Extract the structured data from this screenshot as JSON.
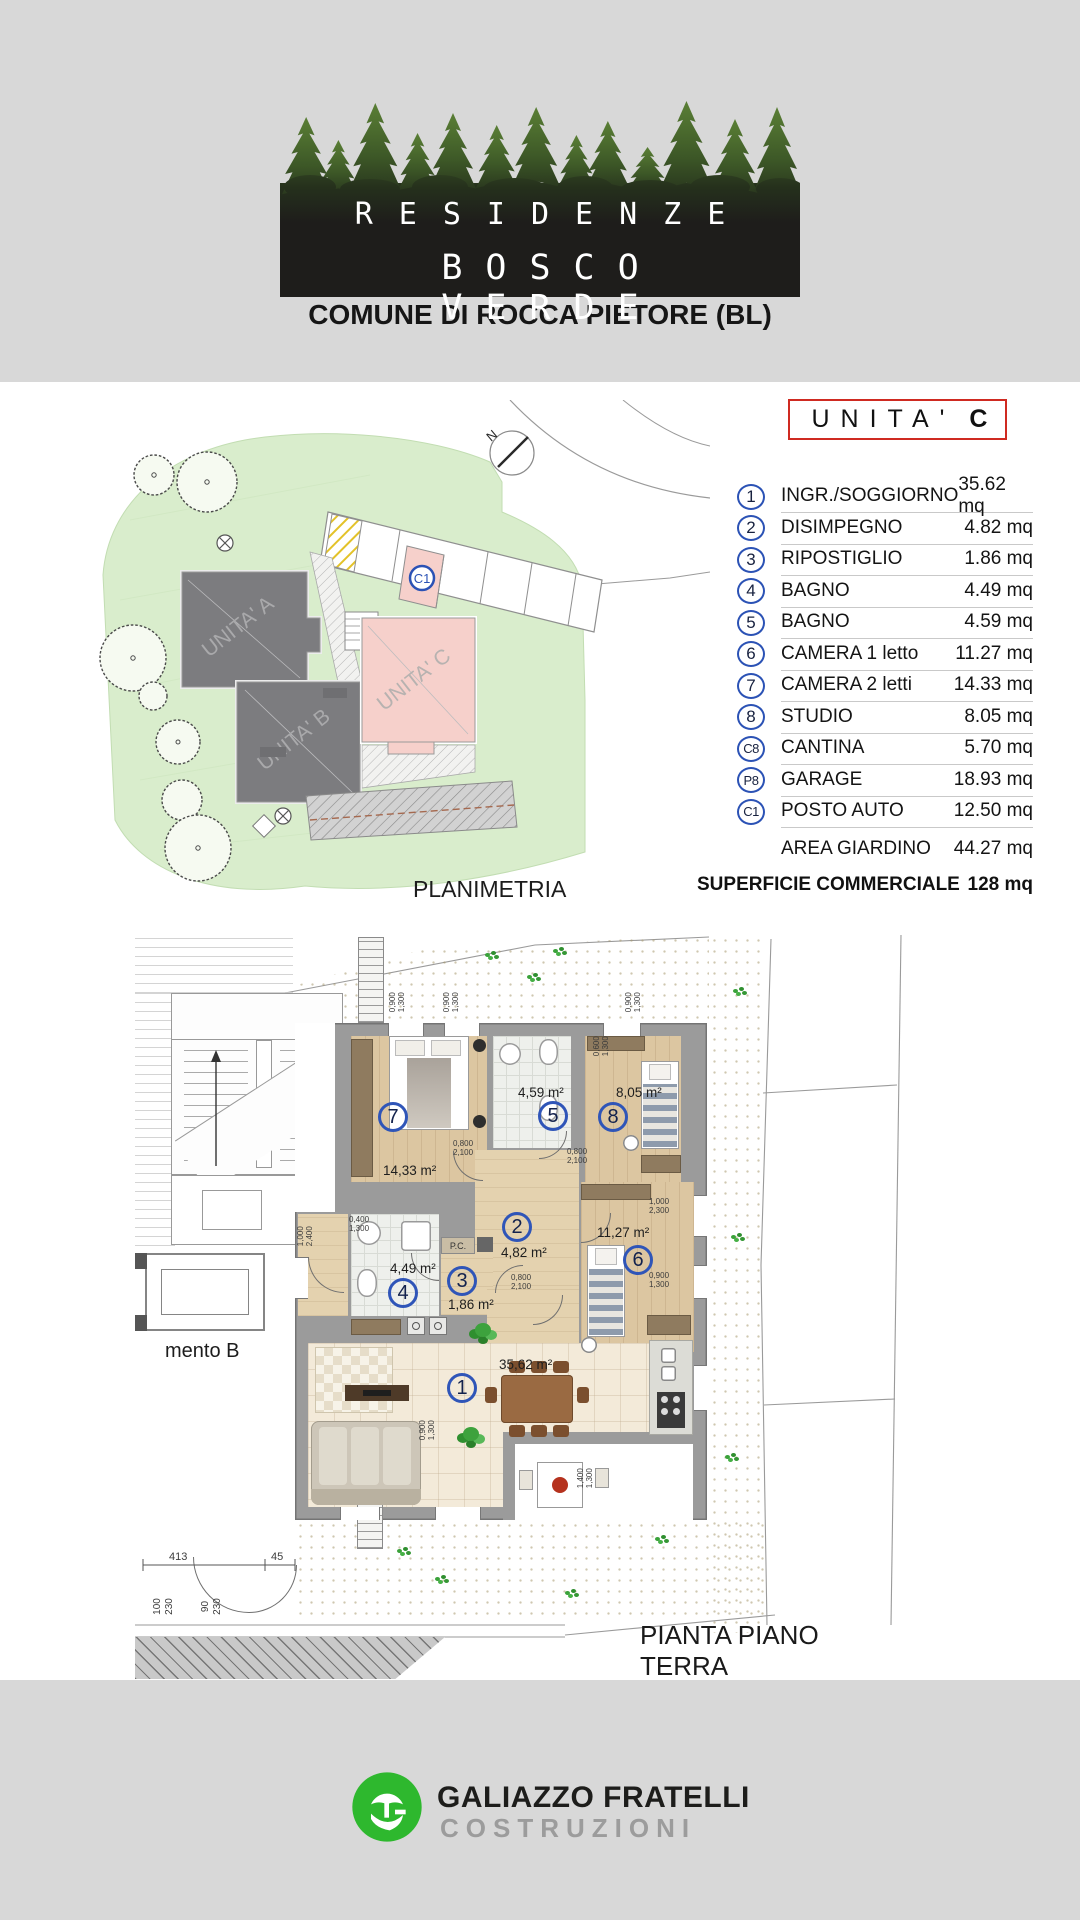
{
  "header": {
    "title_line1": "RESIDENZE",
    "title_line2": "BOSCO VERDE",
    "subtitle": "COMUNE DI ROCCA PIETORE (BL)"
  },
  "colors": {
    "accent_blue": "#2b52b5",
    "accent_red": "#cf2a21",
    "brand_green": "#2eb82e",
    "unit_c_pink": "#f6d0cb",
    "lawn_green": "#d9edcc"
  },
  "unit_box": {
    "prefix": "UNITA'",
    "suffix": "C"
  },
  "legend": {
    "rows": [
      {
        "id": "1",
        "label": "INGR./SOGGIORNO",
        "value": "35.62 mq"
      },
      {
        "id": "2",
        "label": "DISIMPEGNO",
        "value": "4.82 mq"
      },
      {
        "id": "3",
        "label": "RIPOSTIGLIO",
        "value": "1.86 mq"
      },
      {
        "id": "4",
        "label": "BAGNO",
        "value": "4.49 mq"
      },
      {
        "id": "5",
        "label": "BAGNO",
        "value": "4.59 mq"
      },
      {
        "id": "6",
        "label": "CAMERA 1 letto",
        "value": "11.27 mq"
      },
      {
        "id": "7",
        "label": "CAMERA 2 letti",
        "value": "14.33 mq"
      },
      {
        "id": "8",
        "label": "STUDIO",
        "value": "8.05 mq"
      },
      {
        "id": "C8",
        "label": "CANTINA",
        "value": "5.70 mq"
      },
      {
        "id": "P8",
        "label": "GARAGE",
        "value": "18.93 mq"
      },
      {
        "id": "C1",
        "label": "POSTO AUTO",
        "value": "12.50 mq"
      },
      {
        "id": "",
        "label": "AREA GIARDINO",
        "value": "44.27 mq"
      }
    ],
    "total_label": "SUPERFICIE COMMERCIALE",
    "total_value": "128 mq"
  },
  "siteplan": {
    "caption": "PLANIMETRIA",
    "unit_a": "UNITA' A",
    "unit_b": "UNITA' B",
    "unit_c": "UNITA' C",
    "stall_c1": "C1",
    "north": "N"
  },
  "floorplan": {
    "caption": "PIANTA PIANO TERRA",
    "neighbor_label": "mento B",
    "pc_label": "P.C.",
    "rooms": [
      {
        "num": "7",
        "area": "14,33 m²"
      },
      {
        "num": "5",
        "area": "4,59 m²"
      },
      {
        "num": "8",
        "area": "8,05 m²"
      },
      {
        "num": "2",
        "area": "4,82 m²"
      },
      {
        "num": "6",
        "area": "11,27 m²"
      },
      {
        "num": "3",
        "area": "1,86 m²"
      },
      {
        "num": "4",
        "area": "4,49 m²"
      },
      {
        "num": "1",
        "area": "35,62 m²"
      }
    ],
    "dims": [
      "0,900\n1,300",
      "0,900\n1,300",
      "0,900\n1,300",
      "0,600\n1,300",
      "1,000\n2,300",
      "0,900\n1,300",
      "0,800\n2,100",
      "0,800\n2,100",
      "1,000\n2,400",
      "0,400\n1,300",
      "0,800\n2,100",
      "0,900\n1,300",
      "1,400\n1,300",
      "413",
      "45",
      "100\n230",
      "90\n230"
    ]
  },
  "footer": {
    "line1": "GALIAZZO FRATELLI",
    "line2": "COSTRUZIONI"
  }
}
